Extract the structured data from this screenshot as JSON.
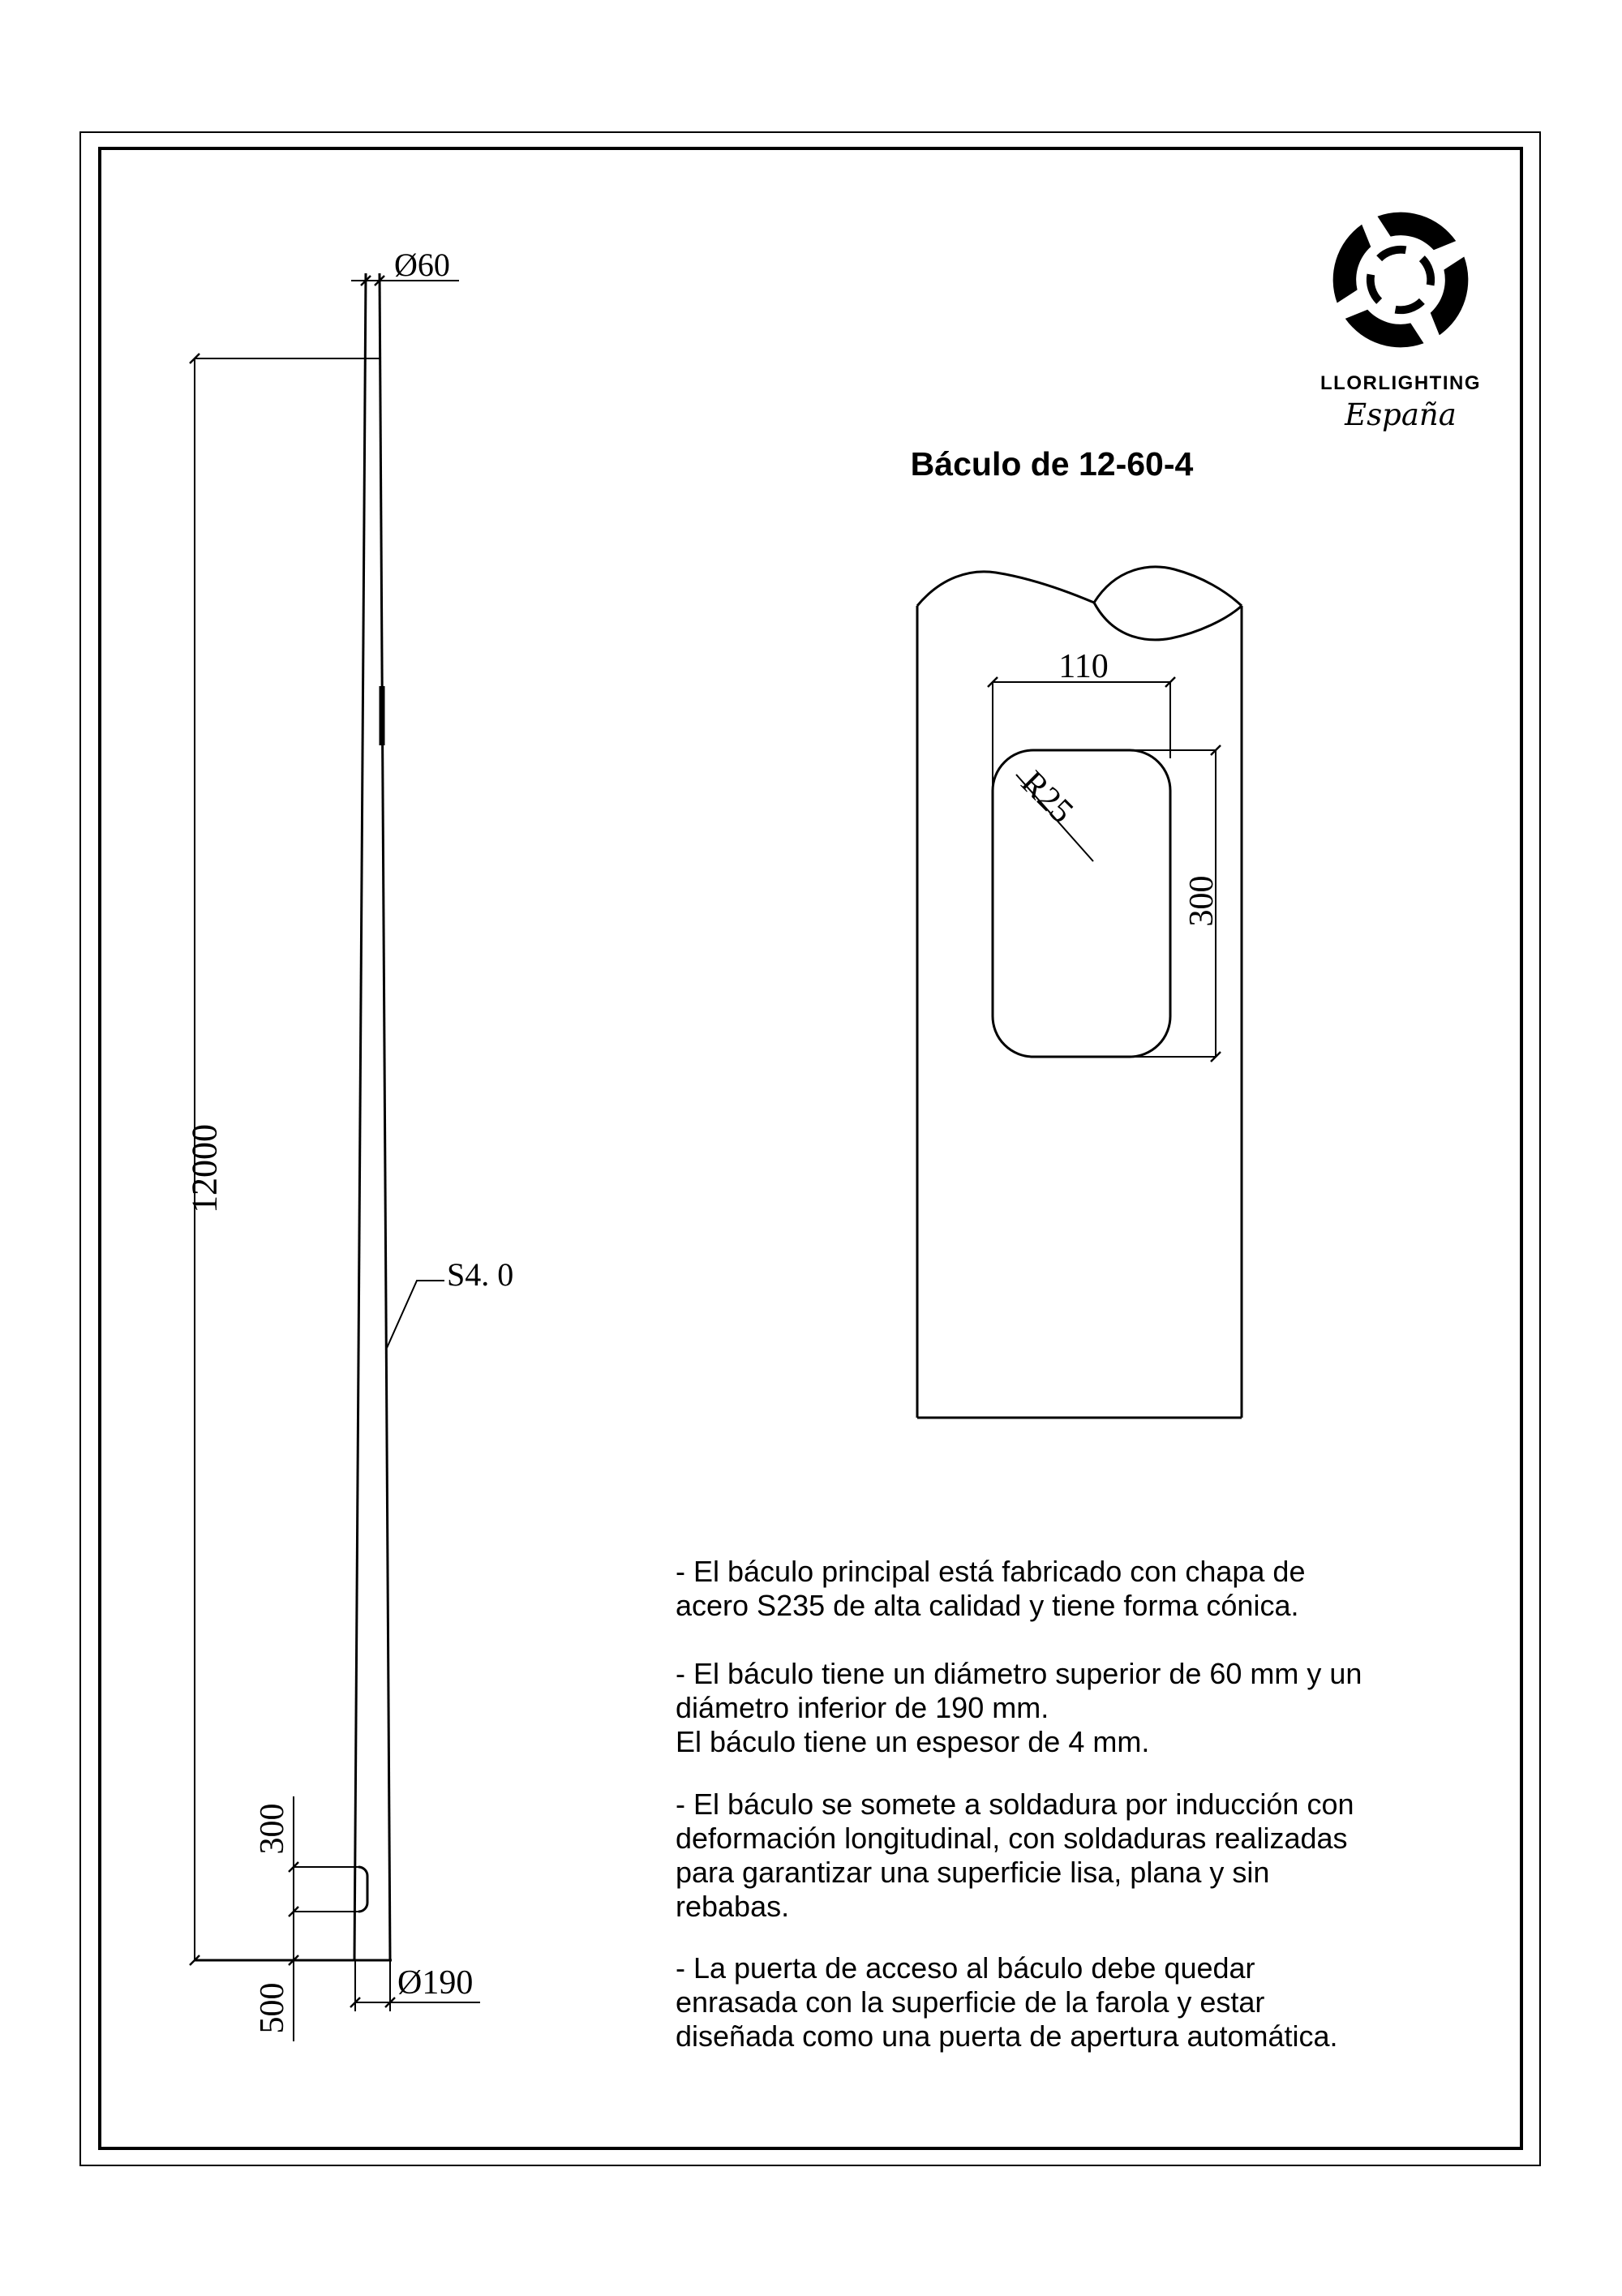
{
  "page": {
    "title": "Báculo de 12-60-4"
  },
  "logo": {
    "company": "LLORLIGHTING",
    "country": "España"
  },
  "left_view": {
    "dim_top_diameter": "Ø60",
    "dim_total_height": "12000",
    "thickness_callout": "S4. 0",
    "dim_door_height": "300",
    "dim_door_to_base": "500",
    "dim_base_diameter": "Ø190"
  },
  "detail_view": {
    "dim_door_width": "110",
    "corner_radius_callout": "R25",
    "dim_door_height": "300"
  },
  "notes": [
    "- El báculo principal está fabricado con chapa de\nacero S235 de alta calidad y tiene forma cónica.",
    "- El báculo tiene un diámetro superior de 60 mm y un\ndiámetro inferior de 190 mm.\nEl báculo tiene un espesor de 4 mm.",
    "- El báculo se somete a soldadura por inducción con\ndeformación longitudinal, con soldaduras realizadas\npara garantizar una superficie lisa, plana y sin\nrebabas.",
    "- La puerta de acceso al báculo debe quedar\nenrasada con la superficie de la farola y estar\ndiseñada como una puerta de apertura automática."
  ],
  "colors": {
    "line": "#000000",
    "background": "#ffffff"
  }
}
